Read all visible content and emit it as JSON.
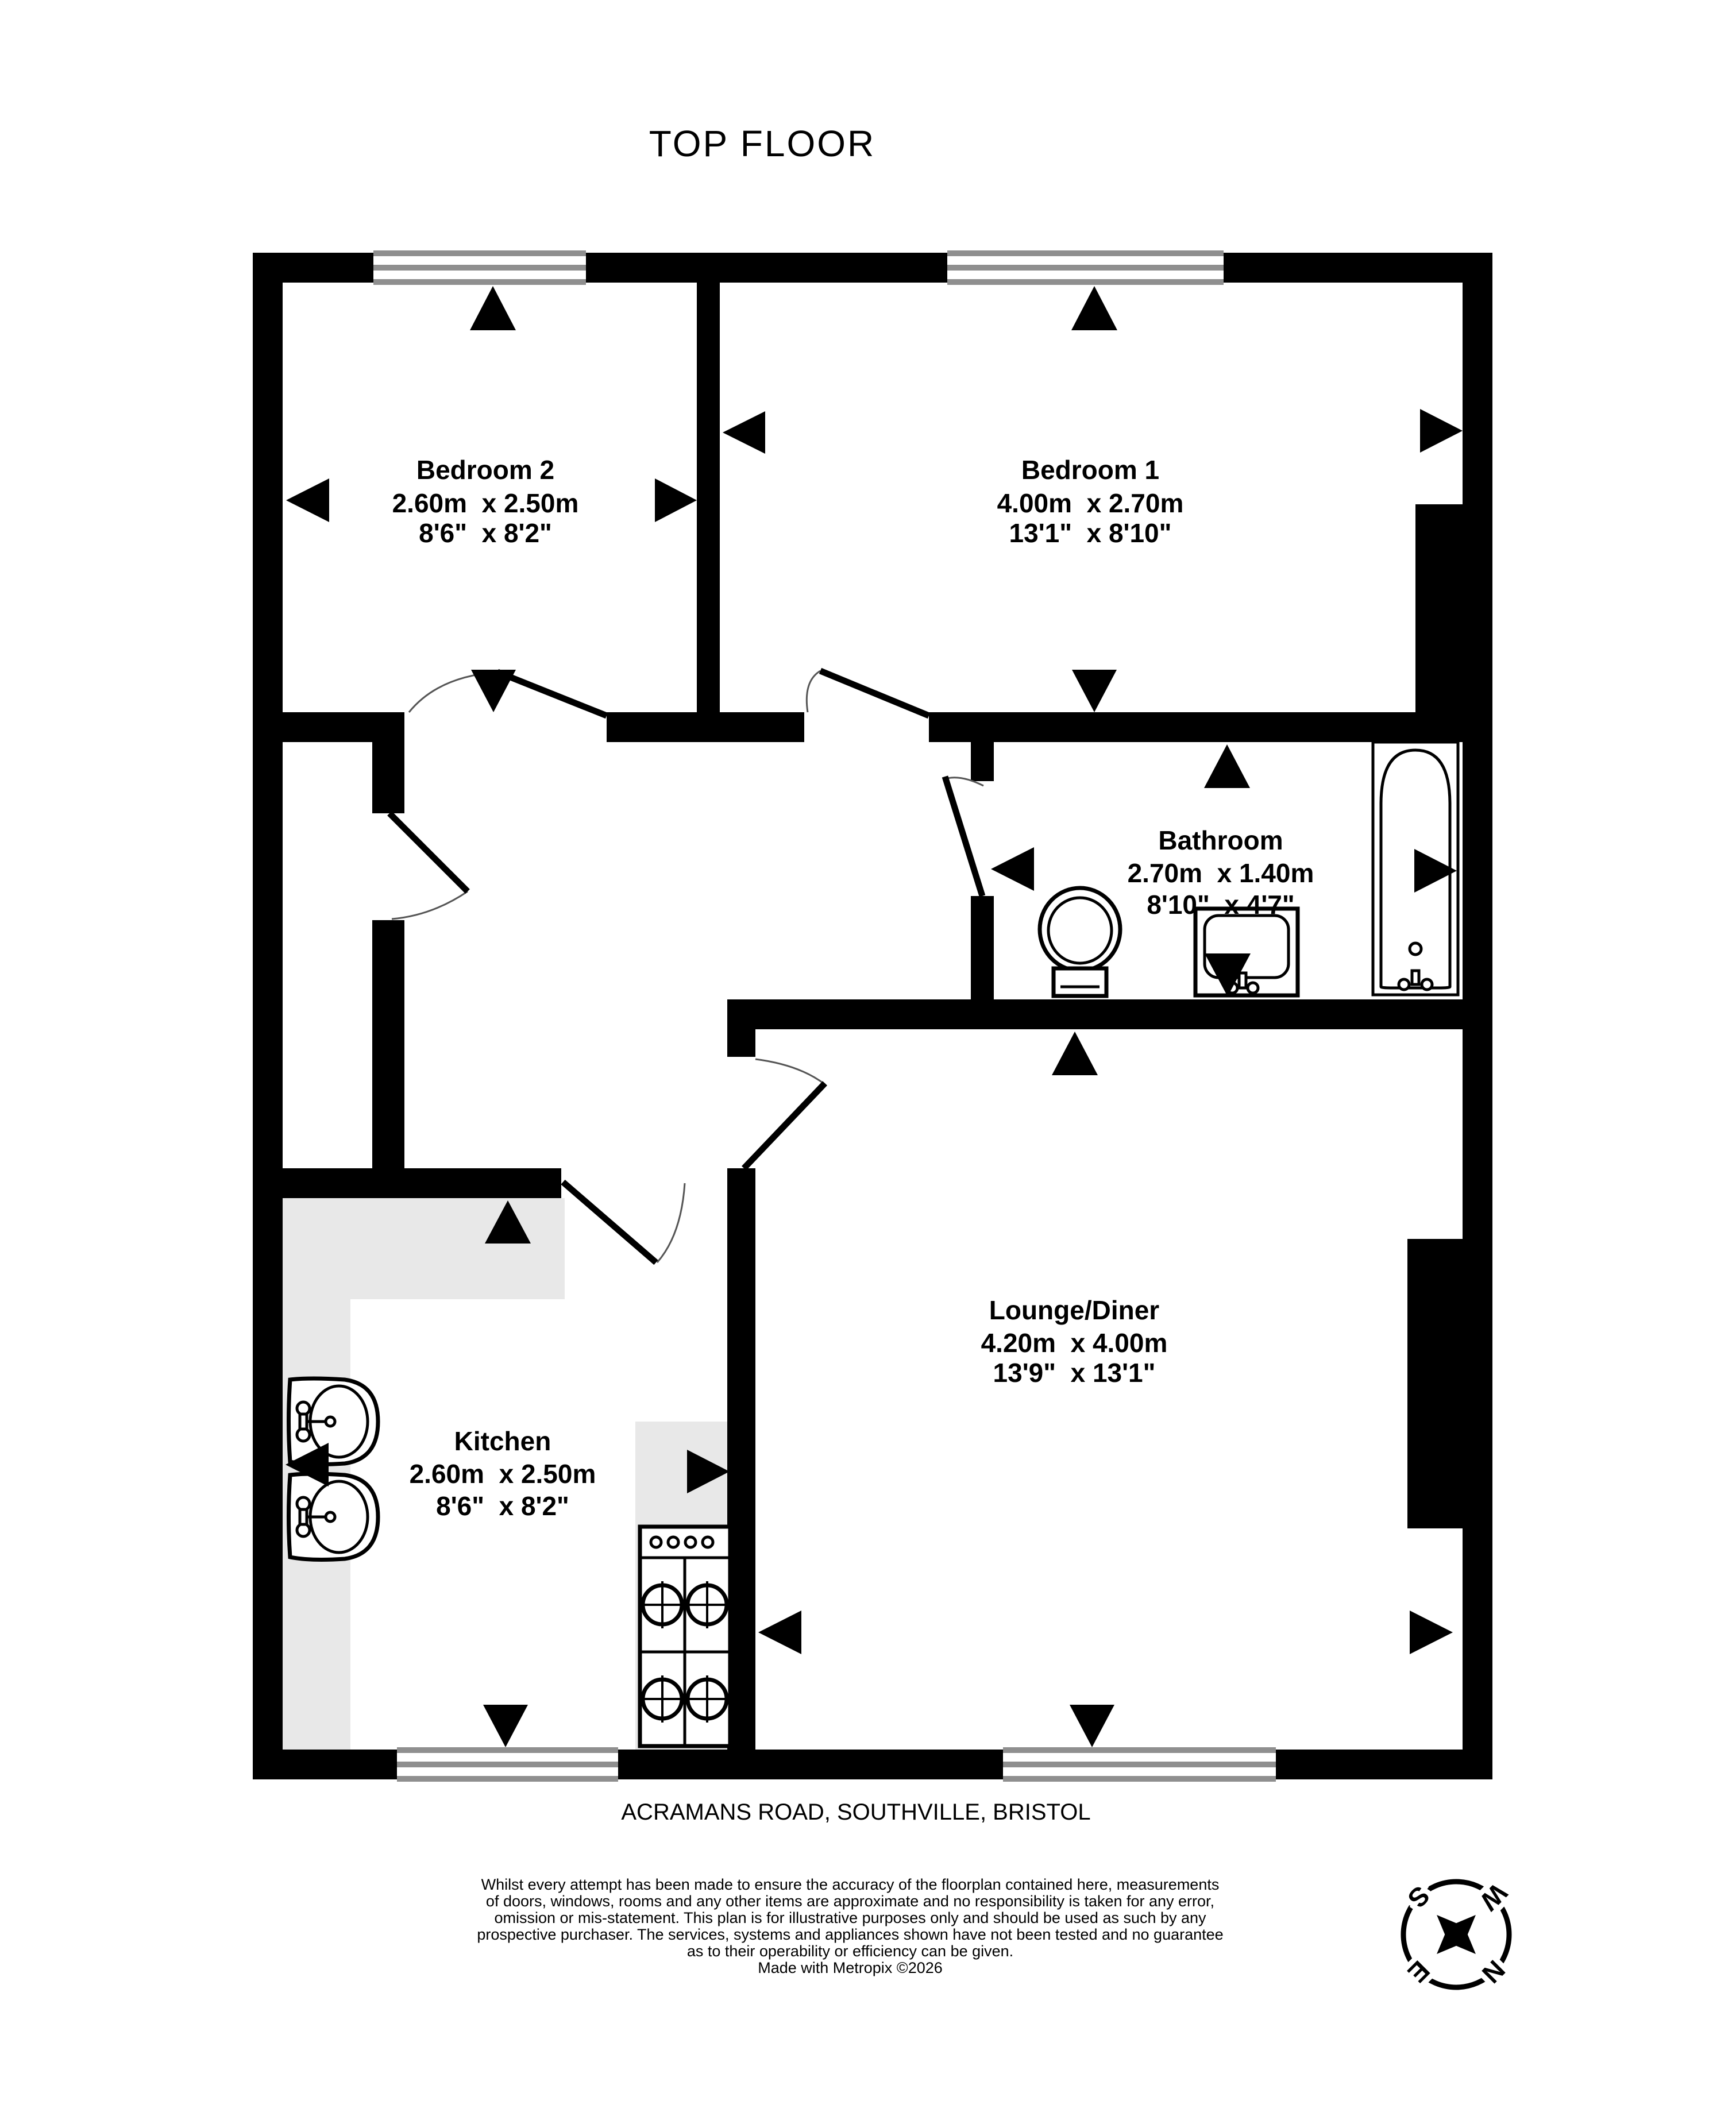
{
  "title": "TOP FLOOR",
  "address": "ACRAMANS ROAD, SOUTHVILLE, BRISTOL",
  "rooms": [
    {
      "id": "bedroom2",
      "name": "Bedroom 2",
      "metric": "2.60m  x 2.50m",
      "imperial": "8'6\"  x 8'2\""
    },
    {
      "id": "bedroom1",
      "name": "Bedroom 1",
      "metric": "4.00m  x 2.70m",
      "imperial": "13'1\"  x 8'10\""
    },
    {
      "id": "bathroom",
      "name": "Bathroom",
      "metric": "2.70m  x 1.40m",
      "imperial": "8'10\"  x 4'7\""
    },
    {
      "id": "kitchen",
      "name": "Kitchen",
      "metric": "2.60m  x 2.50m",
      "imperial": "8'6\"  x 8'2\""
    },
    {
      "id": "lounge",
      "name": "Lounge/Diner",
      "metric": "4.20m  x 4.00m",
      "imperial": "13'9\"  x 13'1\""
    }
  ],
  "disclaimer_lines": [
    "Whilst every attempt has been made to ensure the accuracy of the floorplan contained here, measurements",
    "of doors, windows, rooms and any other items are approximate and no responsibility is taken for any error,",
    "omission or mis-statement. This plan is for illustrative purposes only and should be used as such by any",
    "prospective purchaser. The services, systems and appliances shown have not been tested and no guarantee",
    "as to their operability or efficiency can be given.",
    "Made with Metropix ©2026"
  ],
  "compass": {
    "n": "N",
    "e": "E",
    "s": "S",
    "w": "W",
    "rotation_deg": 135
  },
  "fixtures": [
    "bathtub-icon",
    "toilet-icon",
    "washbasin-icon",
    "kitchen-sink-icon",
    "kitchen-sink-icon",
    "cooker-hob-icon",
    "compass-icon"
  ],
  "colors": {
    "wall": "#000000",
    "counter": "#e8e8e8",
    "window_frame": "#8f8f8f",
    "background": "#ffffff"
  }
}
